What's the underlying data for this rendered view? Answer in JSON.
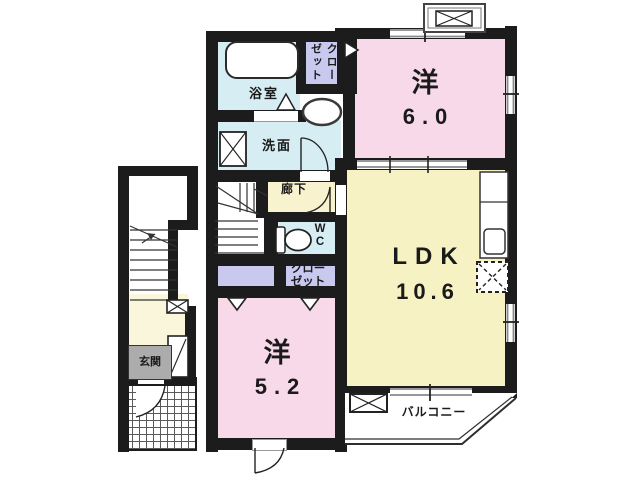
{
  "rooms": {
    "bath": {
      "label": "浴室"
    },
    "closet_upper": {
      "column_right": "クロー",
      "column_left": "ゼット"
    },
    "washroom": {
      "label": "洗面"
    },
    "corridor": {
      "label": "廊下"
    },
    "wc": {
      "line1": "W",
      "line2": "C"
    },
    "closet_lower": {
      "line1": "クロー",
      "line2": "ゼット"
    },
    "bedroom_upper": {
      "name": "洋",
      "size": "6.0"
    },
    "ldk": {
      "name": "LDK",
      "size": "10.6"
    },
    "bedroom_lower": {
      "name": "洋",
      "size": "5.2"
    },
    "entrance": {
      "label": "玄関"
    },
    "balcony": {
      "label": "バルコニー"
    }
  },
  "colors": {
    "wall": "#1c1c1c",
    "room_pink": "#F8D9E9",
    "room_yellow": "#F7F2C3",
    "room_blue": "#D7EDF4",
    "closet_lavender": "#C9C9EF",
    "corridor_cream": "#F8F3CE",
    "hall_cream": "#FAF6DC",
    "entrance_gray": "#ACACAC"
  }
}
